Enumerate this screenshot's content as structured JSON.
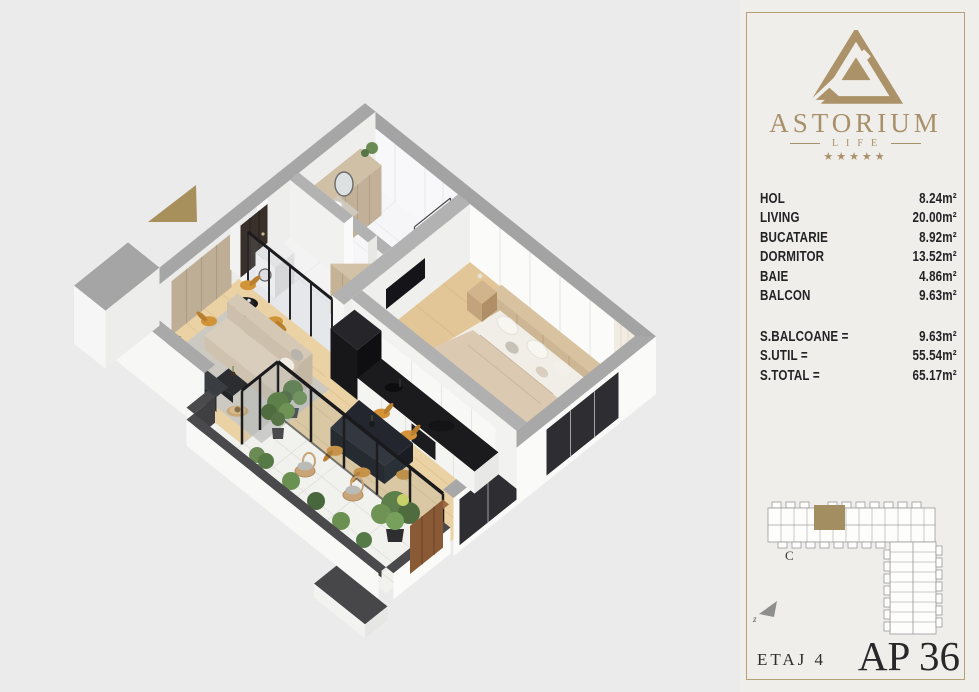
{
  "colors": {
    "accent_gold": "#a8906a",
    "canvas_bg": "#ebebec",
    "panel_bg": "#f0eeea",
    "text_dark": "#222325",
    "unit_highlight": "#a38e61",
    "wood_floor": "#e8cf9f",
    "wall_top_gray": "#a3a3a3"
  },
  "floorplan": {
    "entrance_arrow_icon": "entrance-direction-arrow",
    "render_type": "isometric-apartment-render"
  },
  "panel": {
    "logo": {
      "icon": "astorium-triangle-logo",
      "brand": "ASTORIUM",
      "tagline": "LIFE",
      "stars": "★★★★★"
    },
    "rooms": [
      {
        "label": "HOL",
        "area": "8.24m²"
      },
      {
        "label": "LIVING",
        "area": "20.00m²"
      },
      {
        "label": "BUCATARIE",
        "area": "8.92m²"
      },
      {
        "label": "DORMITOR",
        "area": "13.52m²"
      },
      {
        "label": "BAIE",
        "area": "4.86m²"
      },
      {
        "label": "BALCON",
        "area": "9.63m²"
      }
    ],
    "totals": [
      {
        "label": "S.BALCOANE =",
        "value": "9.63m²"
      },
      {
        "label": "S.UTIL =",
        "value": "55.54m²"
      },
      {
        "label": "S.TOTAL =",
        "value": "65.17m²"
      }
    ],
    "site_plan": {
      "icon": "building-site-plan",
      "section_label": "C",
      "north_label": "z",
      "north_icon": "north-arrow"
    },
    "floor_label": "ETAJ 4",
    "apartment_label": "AP 36"
  }
}
